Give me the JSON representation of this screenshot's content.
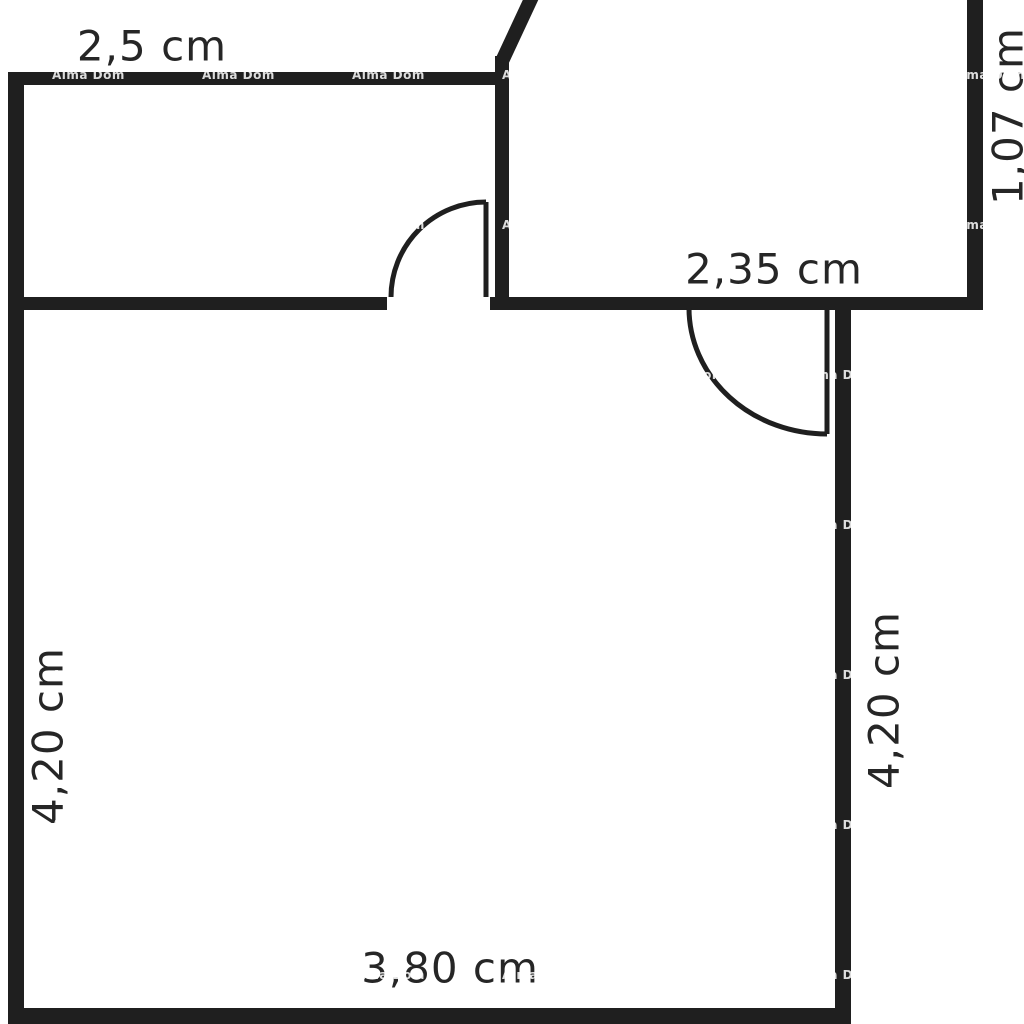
{
  "floorplan": {
    "watermark": "Alma Dom",
    "colors": {
      "wall": "#1f1f1f",
      "label_text": "#262626",
      "background": "#ffffff",
      "watermark_text": "#ffffff"
    },
    "dimensions": {
      "top_room_width": "2,5 cm",
      "upper_right_room_height": "1,07 cm",
      "upper_right_room_width": "2,35 cm",
      "main_room_height_left": "4,20 cm",
      "main_room_height_right": "4,20 cm",
      "main_room_width_bottom": "3,80 cm"
    }
  }
}
